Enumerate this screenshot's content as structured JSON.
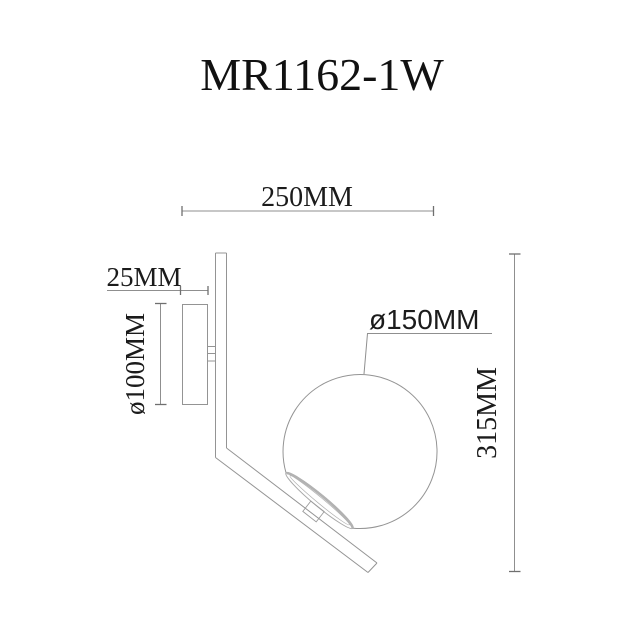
{
  "title": "MR1162-1W",
  "diagram": {
    "kind": "technical-dimension-drawing",
    "subject": "wall-lamp-side-view",
    "dimensions": {
      "overall_width_label": "250MM",
      "backplate_depth_label": "25MM",
      "backplate_diameter_label": "ø100MM",
      "globe_diameter_label": "ø150MM",
      "overall_height_label": "315MM"
    },
    "colors": {
      "background": "#ffffff",
      "drawing_line": "#949494",
      "dimension_line": "#8f8f8f",
      "text": "#1b1b1b"
    }
  }
}
